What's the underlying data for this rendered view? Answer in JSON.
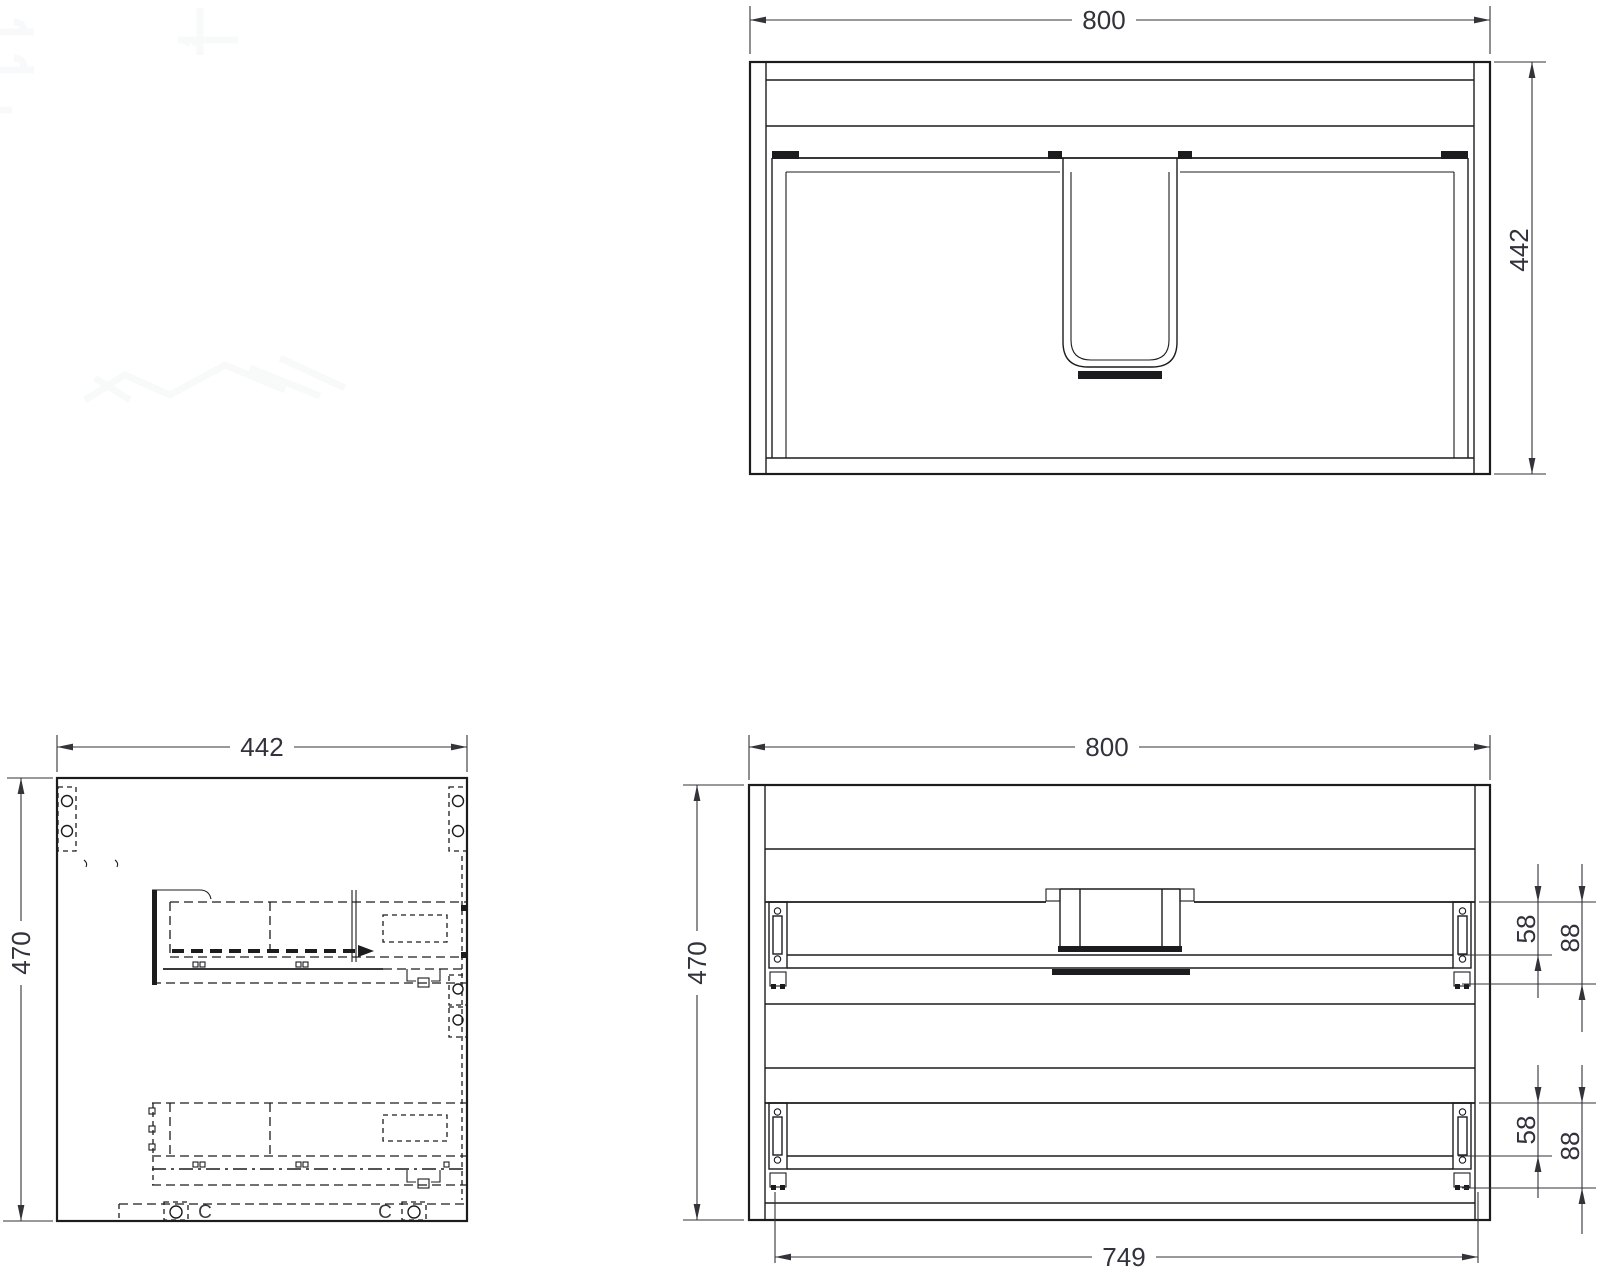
{
  "drawing": {
    "type": "furniture technical drawing, three orthographic views of a wall-hung vanity cabinet",
    "colors": {
      "background": "#ffffff",
      "line": "#1c1c1f",
      "dim_line": "#33333a",
      "dim_text": "#32323c"
    }
  },
  "views": {
    "top": {
      "name": "top view",
      "dim_width": "800",
      "dim_depth": "442"
    },
    "side": {
      "name": "side view",
      "dim_depth": "442",
      "dim_height": "470",
      "cam_label_left": "C",
      "cam_label_right": "C"
    },
    "rear": {
      "name": "rear view",
      "dim_width": "800",
      "dim_height": "470",
      "dim_runner_span": "749",
      "upper": {
        "offset_rail": "58",
        "offset_bracket": "88"
      },
      "lower": {
        "offset_rail": "58",
        "offset_bracket": "88"
      }
    }
  }
}
